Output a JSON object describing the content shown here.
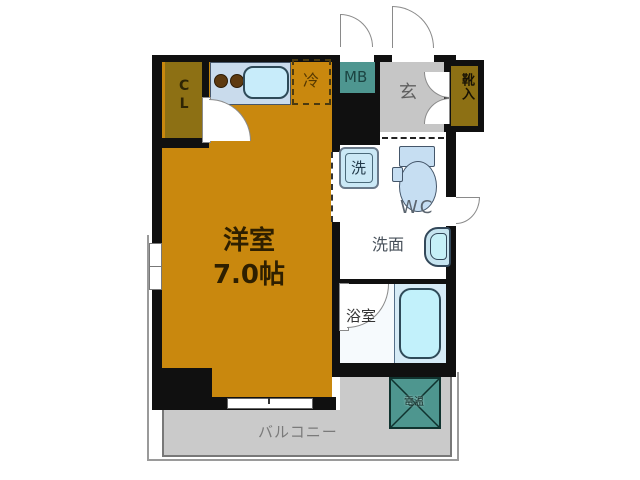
{
  "plan_title": "1K apartment floor plan",
  "rooms": {
    "western_room": {
      "name": "洋室",
      "size": "7.0帖"
    },
    "closet": {
      "label": "CL"
    },
    "refrigerator": {
      "label": "冷"
    },
    "meter_box": {
      "label": "MB"
    },
    "entrance": {
      "label": "玄"
    },
    "shoe_cabinet": {
      "label": "靴入"
    },
    "washer": {
      "label": "洗"
    },
    "toilet": {
      "label": "WC"
    },
    "vanity": {
      "label": "洗面"
    },
    "bathroom": {
      "label": "浴室"
    },
    "balcony": {
      "label": "バルコニー"
    },
    "water_heater": {
      "label": "電温"
    }
  },
  "colors": {
    "wall": "#101010",
    "room_orange": "#C9880E",
    "closet_olive": "#8D7014",
    "meter_teal": "#4E9690",
    "hall_gray": "#C6C6C6",
    "balcony_gray": "#CACACA",
    "counter_blue": "#C9DBEC",
    "fixture_blue": "#C6DEF2",
    "tub_cyan": "#C2F1FB",
    "bath_floor_blue": "#D6EBF6"
  }
}
